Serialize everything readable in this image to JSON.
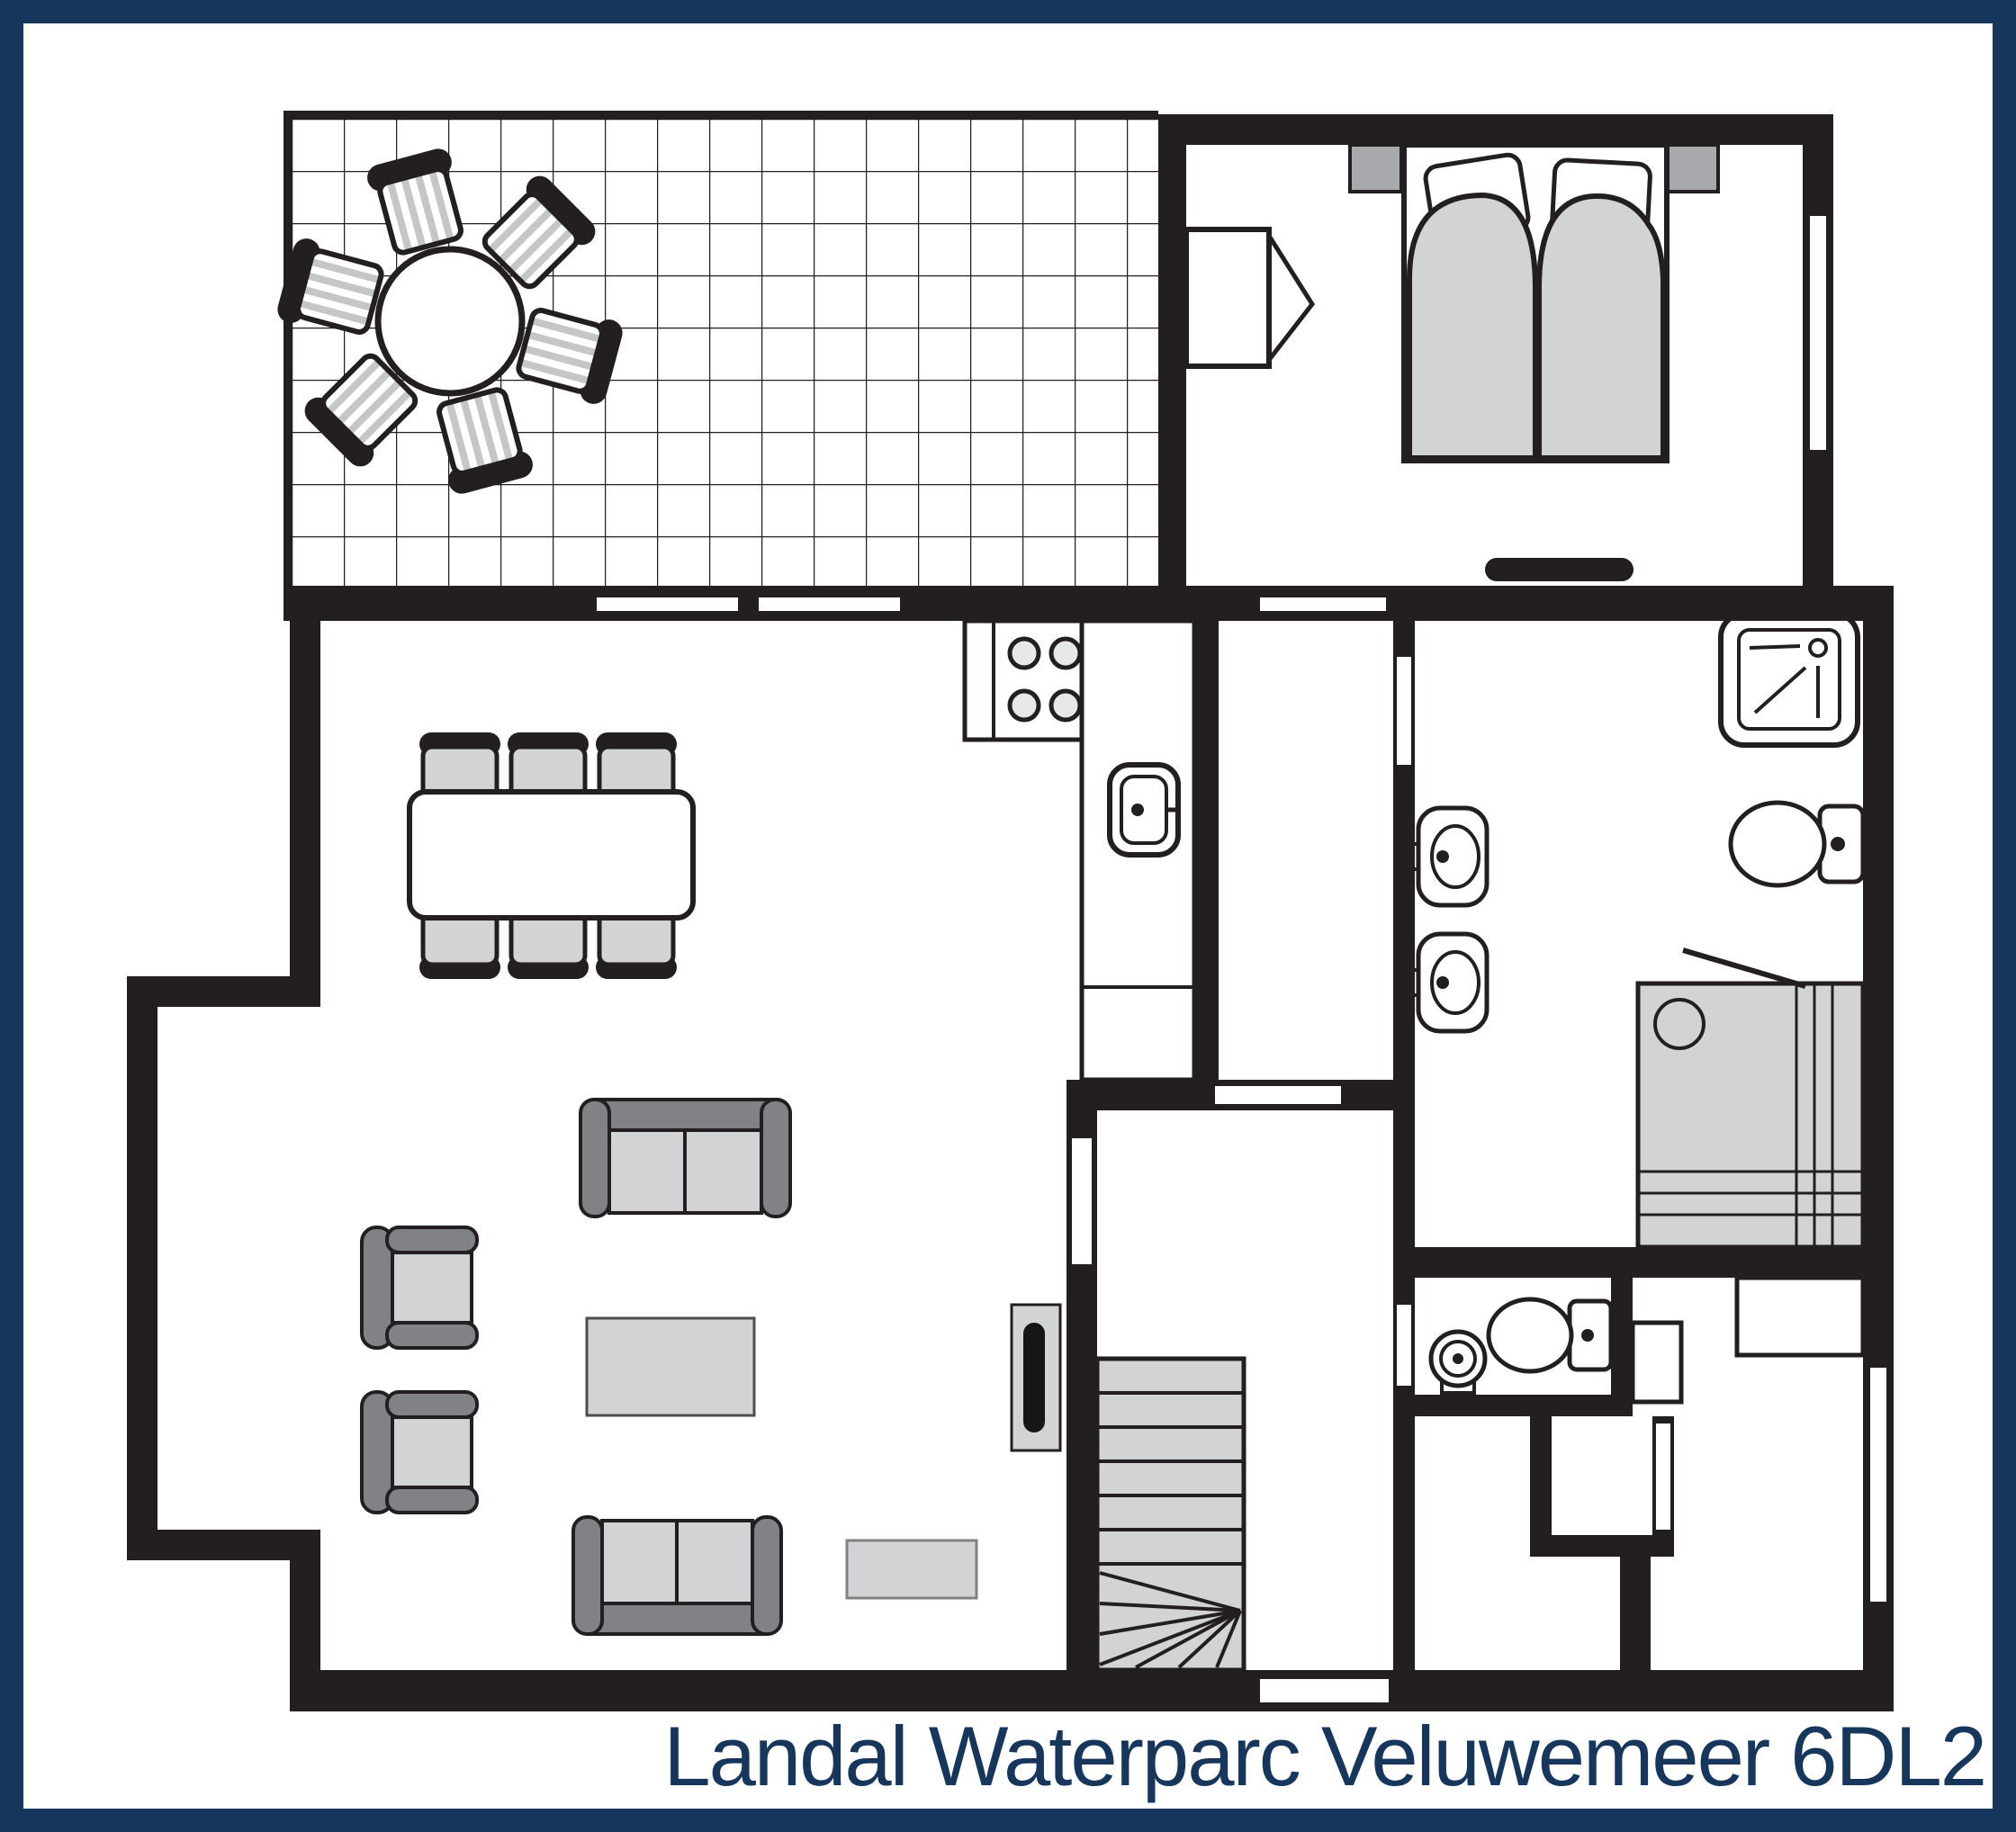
{
  "title": "Landal Waterparc Veluwemeer 6DL2",
  "colors": {
    "frame_navy": "#17365c",
    "wall_black": "#231f20",
    "furniture_light_gray": "#d1d3d4",
    "furniture_mid_gray": "#a7a9ac",
    "furniture_dark_gray": "#808285",
    "background": "#ffffff"
  }
}
